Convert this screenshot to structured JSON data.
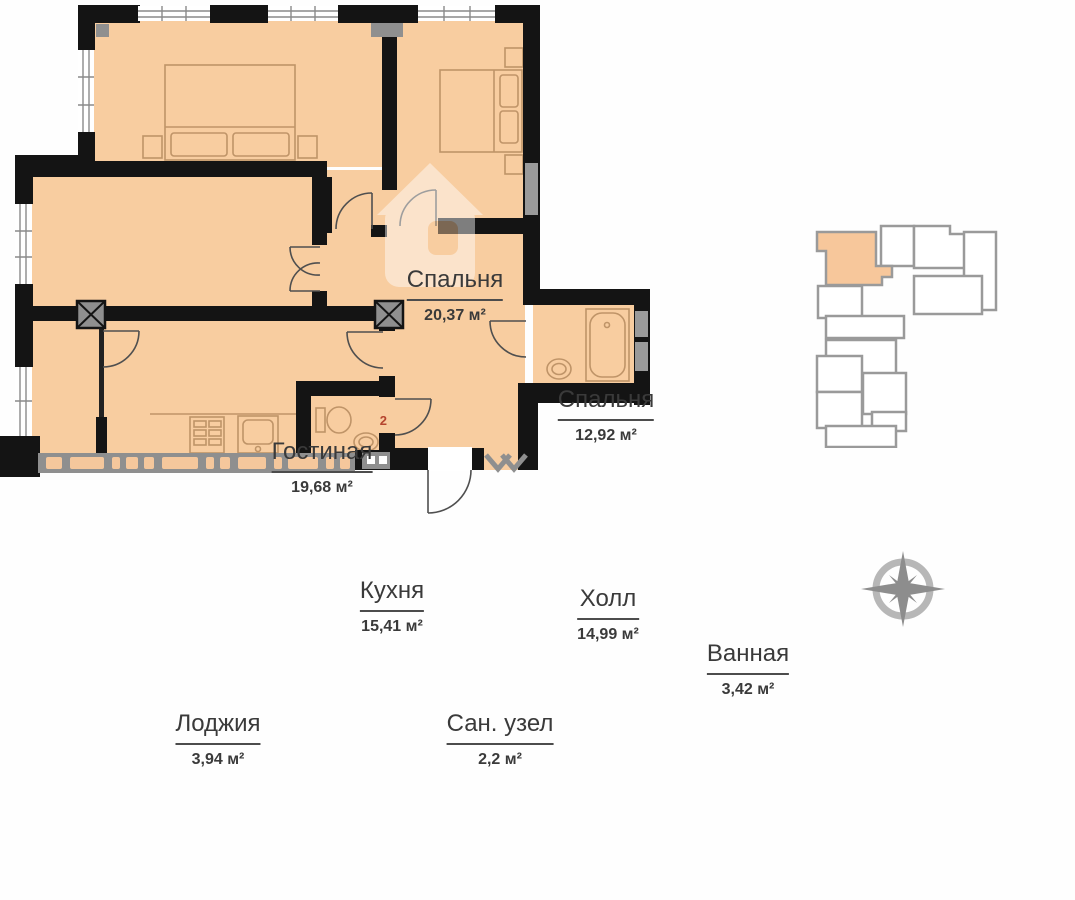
{
  "header": {
    "type_label_big": "3",
    "type_label_rest": "-х ком. кв",
    "area_value": "92,91",
    "area_unit": "м²"
  },
  "rooms": [
    {
      "id": "bedroom-1",
      "name": "Спальня",
      "area": "20,37 м²"
    },
    {
      "id": "bedroom-2",
      "name": "Спальня",
      "area": "12,92 м²"
    },
    {
      "id": "living",
      "name": "Гостиная",
      "area": "19,68 м²"
    },
    {
      "id": "kitchen",
      "name": "Кухня",
      "area": "15,41 м²"
    },
    {
      "id": "hall",
      "name": "Холл",
      "area": "14,99 м²"
    },
    {
      "id": "bathroom",
      "name": "Ванная",
      "area": "3,42 м²"
    },
    {
      "id": "loggia",
      "name": "Лоджия",
      "area": "3,94 м²"
    },
    {
      "id": "wc",
      "name": "Сан. узел",
      "area": "2,2 м²"
    }
  ],
  "plan": {
    "wc_number": "2"
  },
  "colors": {
    "wall": "#141414",
    "floor": "#f8cda0",
    "minimap_highlight": "#f7c79b",
    "minimap_outline": "#9a9a9a",
    "railing": "#8f8f8f",
    "furniture": "#bf9468",
    "door": "#4f4f4f",
    "wc_number": "#b5442e",
    "compass": "#8d8d8d"
  }
}
